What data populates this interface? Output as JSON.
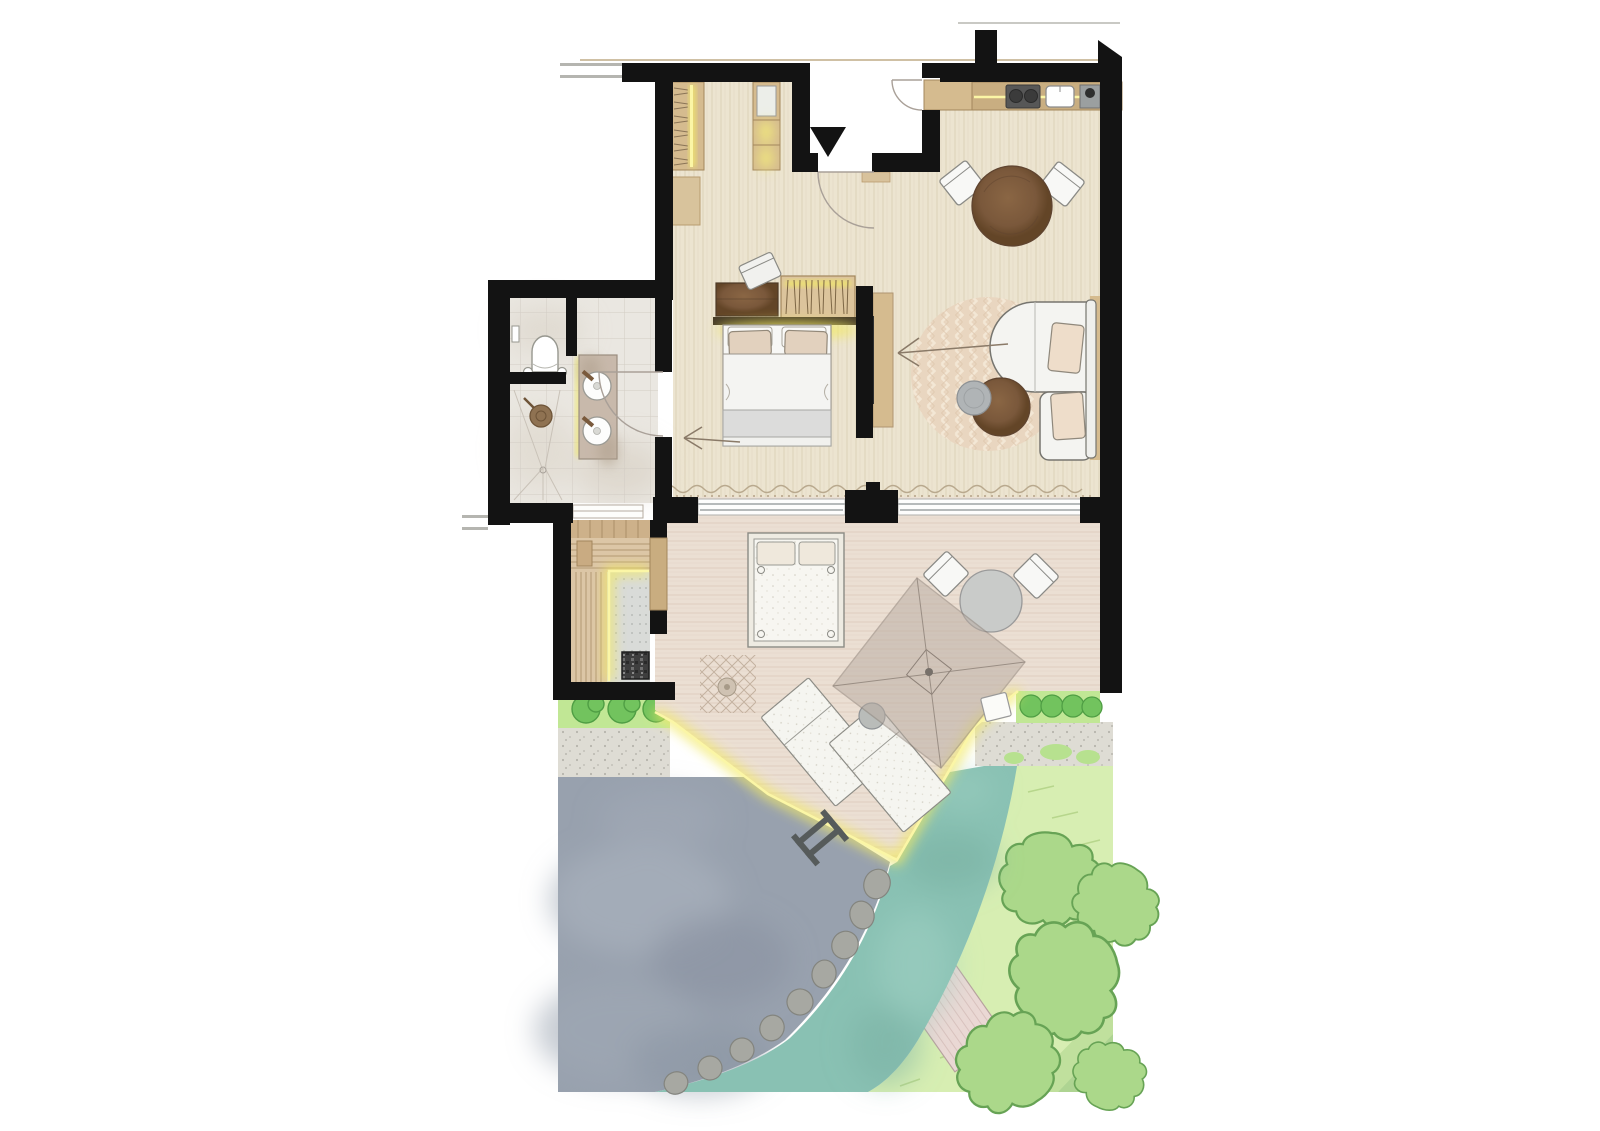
{
  "meta": {
    "title": "Suite floor plan",
    "description": "Architectural top-view floor plan of a suite: entry porch with direction arrow, hallway with wardrobes, kitchenette with cooktop sink and coffee machine, living-dining room with round table chairs chaise sofa rug and TV partition, bedroom with double bed dresser and open wardrobe, bathroom with WC double vanity and shower, sauna with benches and heater, furnished terrace with daybed parasol loungers and dining set, natural swimming pond with ladder and boulders, stream and garden with trees hedges and gravel",
    "type": "floor-plan",
    "view": "top-down"
  },
  "colors": {
    "wall": "#131313",
    "floor": "#ece4d0",
    "floorGrain": "#d8cdb2",
    "deck": "#ebdfd3",
    "deckGrain": "#ddccbc",
    "tile": "#eae7e1",
    "tileLine": "#d2ccc4",
    "marble": "#c8b9ab",
    "oak": "#d5bb8f",
    "oakDark": "#a3875d",
    "walnut": "#7a583b",
    "whiteF": "#f4f4f1",
    "outline": "#77766f",
    "pillow": "#e4d2bf",
    "led": "#f2e966",
    "ledCore": "#fbf6a6",
    "pond": "#98a1ae",
    "stream": "#89c1b3",
    "grass": "#d7eeb2",
    "tree": "#abd88a",
    "treeOutline": "#67a355",
    "hedge": "#c1e795",
    "bush": "#72c35e",
    "bushOutline": "#4f9e44",
    "gravel": "#dedcd4",
    "boulder": "#a7a8a2",
    "rug": "#e9d6c0",
    "platformPink": "#ead8d4",
    "arrow": "#8a7a68"
  },
  "areas": [
    {
      "id": "entry-porch",
      "features": [
        "entry-direction-arrow",
        "entry-door",
        "hall-door"
      ]
    },
    {
      "id": "hallway",
      "features": [
        "wardrobe-hangers",
        "mirror-cabinet",
        "bench"
      ]
    },
    {
      "id": "kitchenette",
      "features": [
        "counter",
        "cooktop",
        "sink",
        "coffee-machine",
        "led-strip"
      ]
    },
    {
      "id": "living-dining",
      "features": [
        "round-dining-table",
        "two-chairs",
        "chaise-sofa",
        "round-rug",
        "coffee-table",
        "pouf",
        "tv-partition",
        "tv-view-arrow",
        "window-ledge"
      ]
    },
    {
      "id": "bedroom",
      "features": [
        "double-bed",
        "headboard-led",
        "dresser",
        "desk-chair",
        "open-wardrobe",
        "door-arrow"
      ]
    },
    {
      "id": "bathroom",
      "features": [
        "wc",
        "double-vanity",
        "vanity-led",
        "shower",
        "shower-head",
        "door-arc"
      ]
    },
    {
      "id": "sauna",
      "features": [
        "upper-bench",
        "side-bench",
        "led-edge",
        "heater"
      ]
    },
    {
      "id": "terrace",
      "features": [
        "outdoor-daybed",
        "lattice-mat",
        "parasol",
        "two-loungers",
        "side-table",
        "outdoor-dining-set",
        "stool",
        "led-deck-edge"
      ]
    },
    {
      "id": "natural-pond",
      "features": [
        "pool-ladder",
        "boulder-edge"
      ]
    },
    {
      "id": "stream",
      "features": []
    },
    {
      "id": "garden",
      "features": [
        "trees",
        "pink-platform",
        "mowing-hatches",
        "hedges",
        "gravel-strips"
      ]
    }
  ],
  "arrows": {
    "entry": "down",
    "tv_view": "left",
    "bathroom_path": "left"
  }
}
